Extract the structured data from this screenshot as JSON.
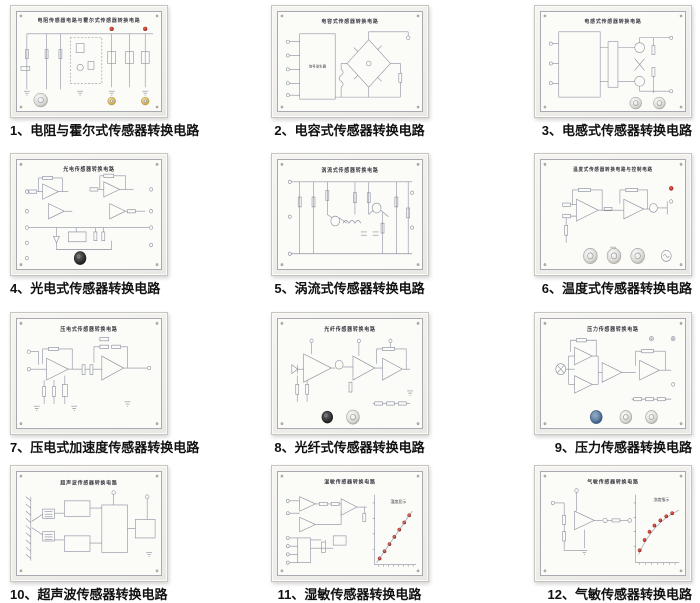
{
  "page": {
    "background": "#ffffff",
    "caption_color": "#111111"
  },
  "colors": {
    "board_frame": "#eceae6",
    "panel_face": "#fbfbf7",
    "schematic_line": "#8a8fa0",
    "led_red": "#b22218",
    "caption_text": "#111111"
  },
  "panels": [
    {
      "num": "1",
      "board_title": "电阻传感器电路与霍尔式传感器转换电路",
      "caption": "1、电阻与霍尔式传感器转换电路"
    },
    {
      "num": "2",
      "board_title": "电容式传感器转换电路",
      "caption": "2、电容式传感器转换电路",
      "box_label": "信号发生器"
    },
    {
      "num": "3",
      "board_title": "电感式传感器转换电路",
      "caption": "3、电感式传感器转换电路"
    },
    {
      "num": "4",
      "board_title": "光电传感器转换电路",
      "caption": "4、光电式传感器转换电路"
    },
    {
      "num": "5",
      "board_title": "涡流式传感器转换电路",
      "caption": "5、涡流式传感器转换电路"
    },
    {
      "num": "6",
      "board_title": "温度式传感器转换电路与控制电路",
      "caption": "6、温度式传感器转换电路"
    },
    {
      "num": "7",
      "board_title": "压电式传感器转换电路",
      "caption": "7、压电式加速度传感器转换电路"
    },
    {
      "num": "8",
      "board_title": "光纤传感器转换电路",
      "caption": "8、光纤式传感器转换电路"
    },
    {
      "num": "9",
      "board_title": "压力传感器转换电路",
      "caption": "9、压力传感器转换电路"
    },
    {
      "num": "10",
      "board_title": "超声波传感器转换电路",
      "caption": "10、超声波传感器转换电路"
    },
    {
      "num": "11",
      "board_title": "湿敏传感器转换电路",
      "caption": "11、湿敏传感器转换电路",
      "graph_label": "湿度显示"
    },
    {
      "num": "12",
      "board_title": "气敏传感器转换电路",
      "caption": "12、气敏传感器转换电路",
      "graph_label": "浓度指示"
    }
  ]
}
